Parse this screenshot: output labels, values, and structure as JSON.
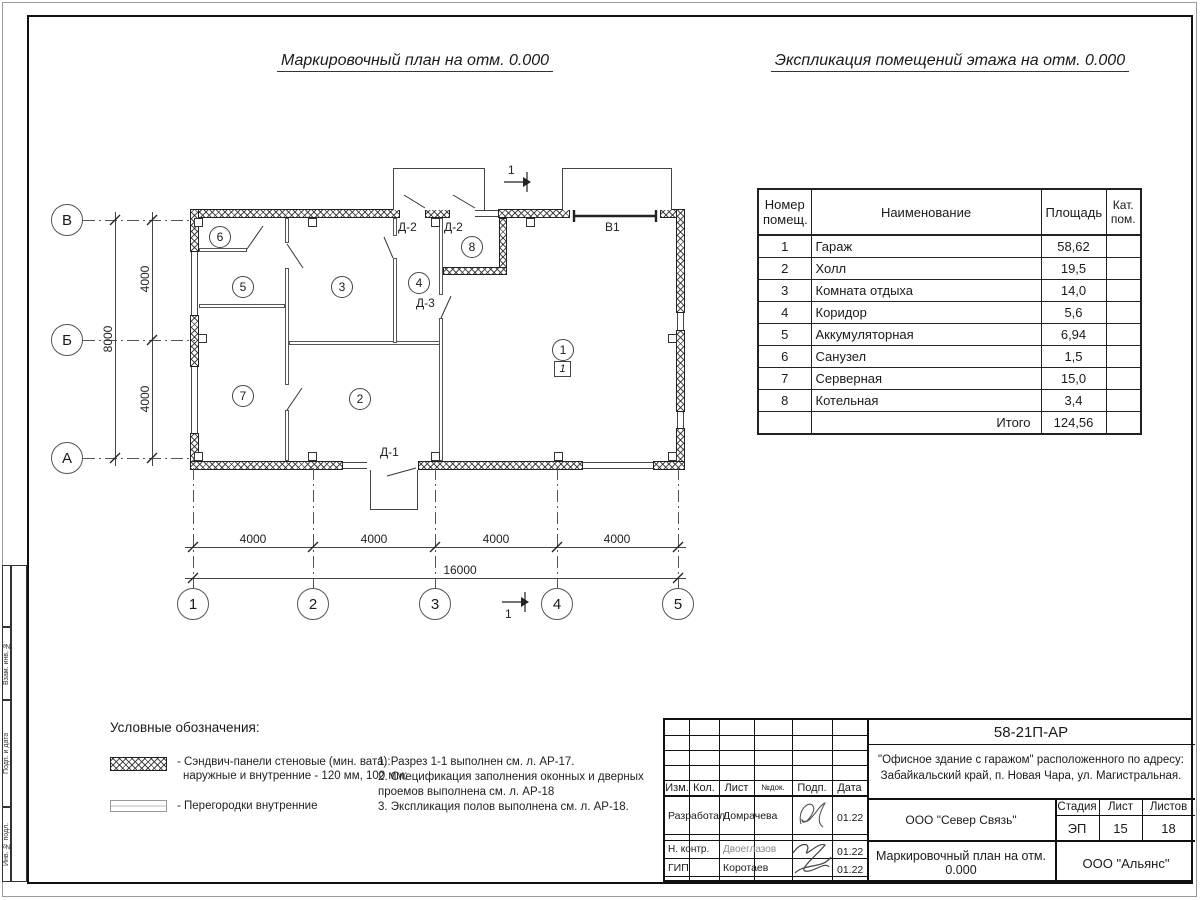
{
  "colors": {
    "ink": "#1a1a1a"
  },
  "titles": {
    "plan": "Маркировочный план на отм. 0.000",
    "table": "Экспликация помещений этажа на отм. 0.000"
  },
  "table": {
    "headers": {
      "num": "Номер помещ.",
      "name": "Наименование",
      "area": "Площадь",
      "cat": "Кат. пом."
    },
    "rows": [
      {
        "num": "1",
        "name": "Гараж",
        "area": "58,62",
        "cat": ""
      },
      {
        "num": "2",
        "name": "Холл",
        "area": "19,5",
        "cat": ""
      },
      {
        "num": "3",
        "name": "Комната отдыха",
        "area": "14,0",
        "cat": ""
      },
      {
        "num": "4",
        "name": "Коридор",
        "area": "5,6",
        "cat": ""
      },
      {
        "num": "5",
        "name": "Аккумуляторная",
        "area": "6,94",
        "cat": ""
      },
      {
        "num": "6",
        "name": "Санузел",
        "area": "1,5",
        "cat": ""
      },
      {
        "num": "7",
        "name": "Серверная",
        "area": "15,0",
        "cat": ""
      },
      {
        "num": "8",
        "name": "Котельная",
        "area": "3,4",
        "cat": ""
      }
    ],
    "total_label": "Итого",
    "total_value": "124,56"
  },
  "plan": {
    "rooms": [
      "1",
      "2",
      "3",
      "4",
      "5",
      "6",
      "7",
      "8"
    ],
    "floor_mark": "1",
    "doors": {
      "d2a": "Д-2",
      "d2b": "Д-2",
      "d3": "Д-3",
      "d1": "Д-1"
    },
    "gate": "В1",
    "section_mark": "1",
    "axes": {
      "rows": [
        "В",
        "Б",
        "А"
      ],
      "cols": [
        "1",
        "2",
        "3",
        "4",
        "5"
      ]
    },
    "dims": {
      "bottom": [
        "4000",
        "4000",
        "4000",
        "4000"
      ],
      "bottom_total": "16000",
      "left": [
        "4000",
        "4000"
      ],
      "left_total": "8000"
    }
  },
  "legend": {
    "heading": "Условные обозначения:",
    "item1_line1": "- Сэндвич-панели стеновые (мин. вата):",
    "item1_line2": "наружные и внутренние - 120 мм, 100 мм;",
    "item2": "- Перегородки внутренние"
  },
  "notes": {
    "line1": "1. Разрез 1-1 выполнен см. л. АР-17.",
    "line2": "2. Спецификация заполнения оконных и дверных",
    "line3": "проемов выполнена см. л. АР-18",
    "line4": "3. Экспликация полов выполнена см. л. АР-18."
  },
  "titleblock": {
    "doc_number": "58-21П-АР",
    "project_line1": "\"Офисное здание с гаражом\" расположенного по адресу:",
    "project_line2": "Забайкальский край, п. Новая Чара, ул. Магистральная.",
    "org": "ООО \"Север Связь\"",
    "org2": "ООО \"Альянс\"",
    "drawing_title": "Маркировочный план на отм. 0.000",
    "header_cells": [
      "Изм.",
      "Кол.",
      "Лист",
      "№док.",
      "Подп.",
      "Дата"
    ],
    "stage_label": "Стадия",
    "stage": "ЭП",
    "sheet_label": "Лист",
    "sheet": "15",
    "sheets_label": "Листов",
    "sheets": "18",
    "roles": [
      {
        "role": "Разработал",
        "name": "Домрачева",
        "date": "01.22"
      },
      {
        "role": "Н. контр.",
        "name": "Двоеглазов",
        "date": "01.22"
      },
      {
        "role": "ГИП",
        "name": "Коротаев",
        "date": "01.22"
      }
    ]
  },
  "side_strip": [
    "Взам. инв. №",
    "Подп. и дата",
    "Инв. № подл."
  ]
}
